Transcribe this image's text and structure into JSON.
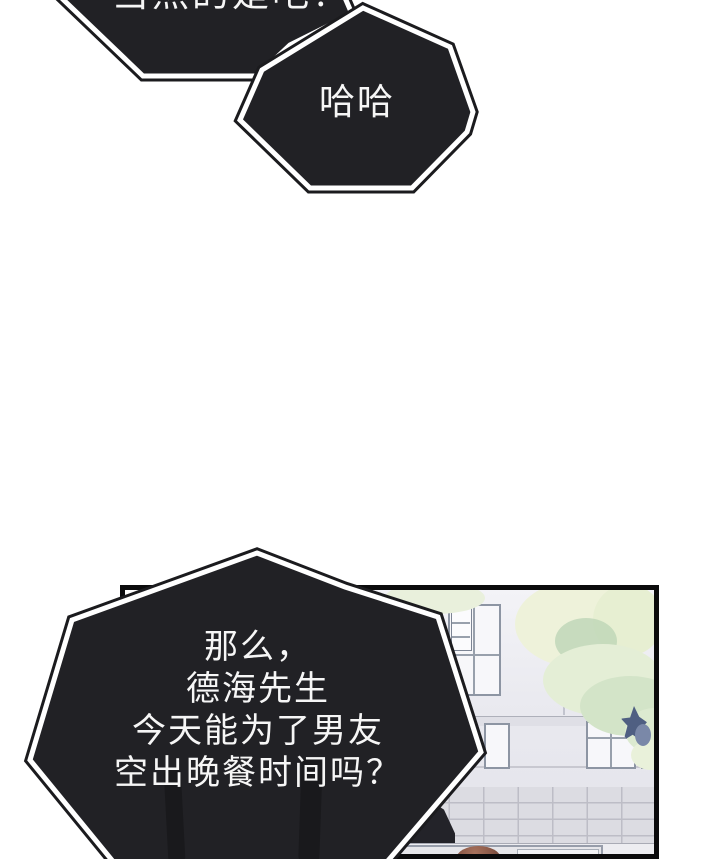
{
  "page": {
    "background": "#ffffff",
    "bubble_fill": "#212125",
    "bubble_outline_inner": "#ffffff",
    "bubble_outline_outer": "#1b1b1e",
    "text_color": "#f6f6f6",
    "panel_border_color": "#0b0b0c"
  },
  "speech": {
    "bubble1": {
      "text": "当然的是吧？"
    },
    "bubble2": {
      "text": "哈哈"
    },
    "bubble3": {
      "lines": [
        "那么，",
        "德海先生",
        "今天能为了男友",
        "空出晚餐时间吗？"
      ]
    }
  },
  "panel_scene": {
    "description_colors": {
      "wall": "#e9e9ef",
      "window_frame": "#8d95a3",
      "foliage_pale": "#f1f4da",
      "foliage_green": "#bed6b6",
      "sprig_blue": "#4f5f82",
      "tile_wall": "#dcdce2",
      "hair_brown": "#8a5847"
    }
  }
}
